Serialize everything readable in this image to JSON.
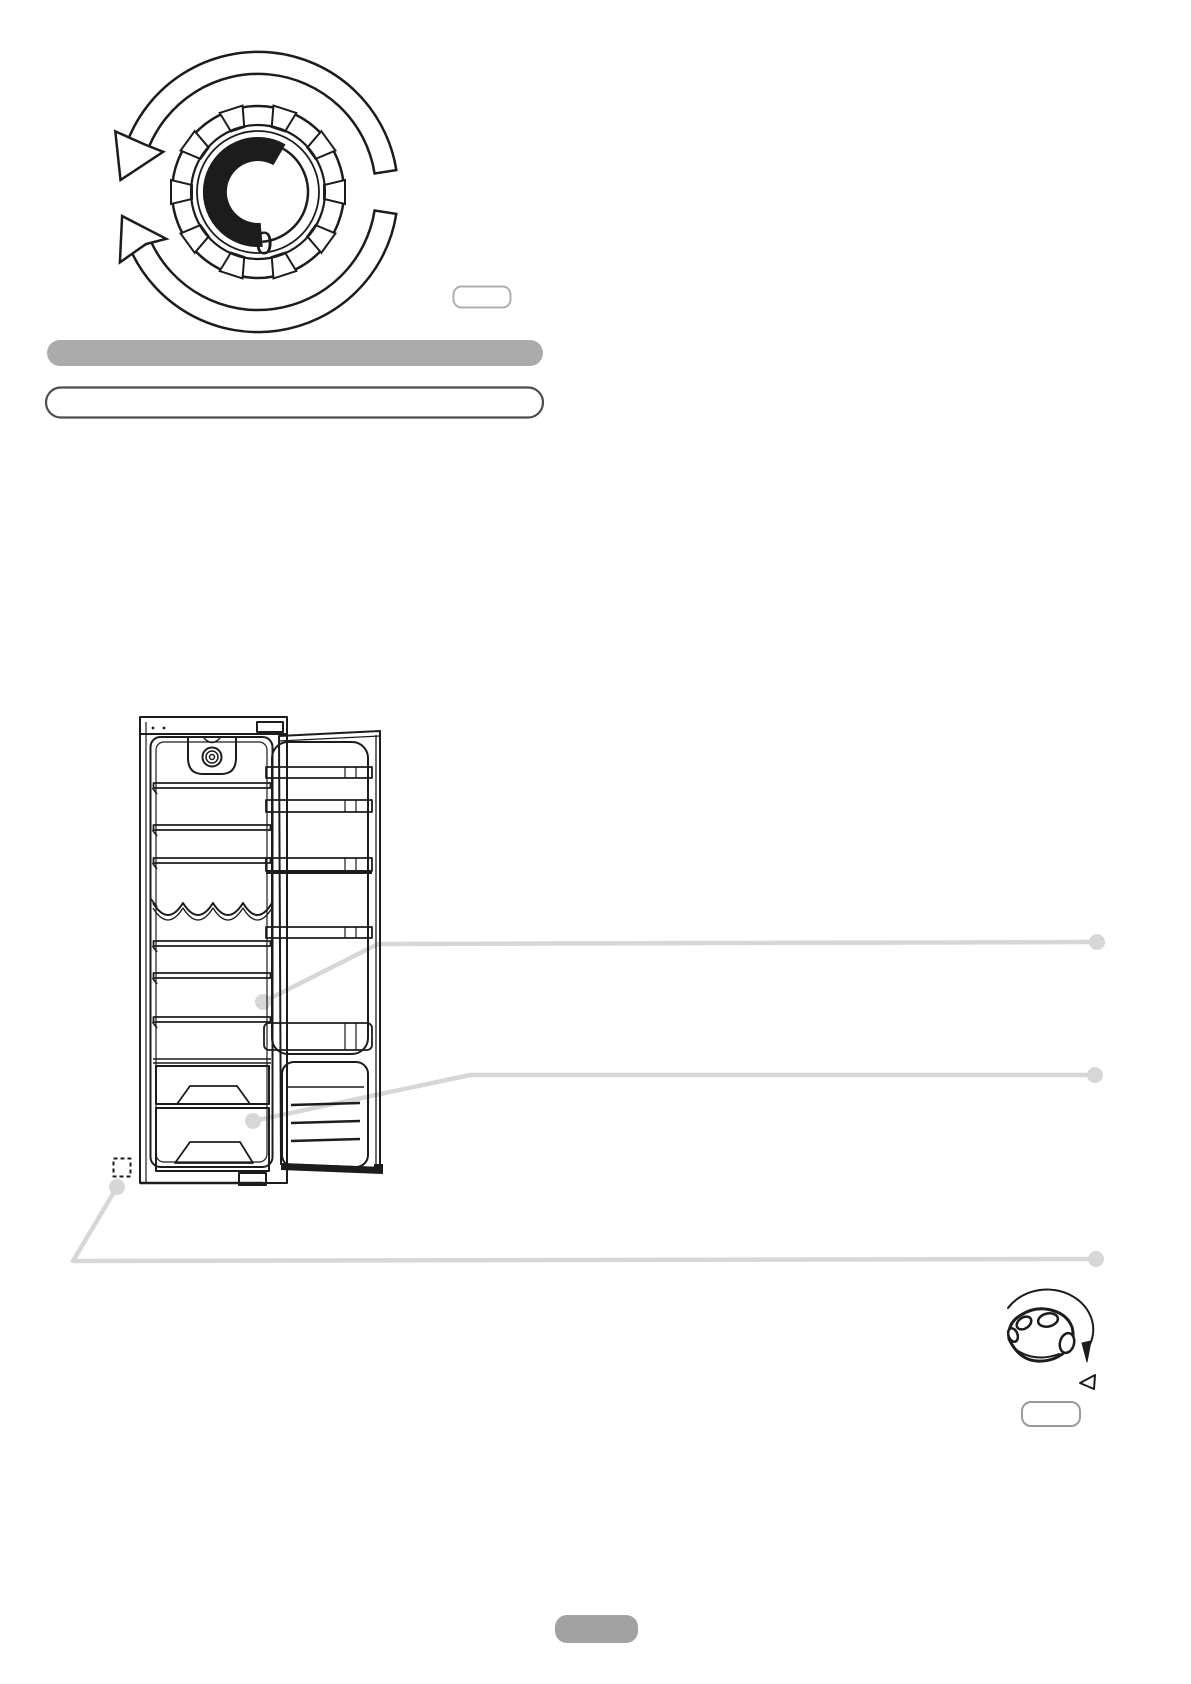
{
  "document": {
    "kind": "refrigerator-manual-page",
    "dial": {
      "zero_label": "0"
    },
    "buttons": {
      "top_pill_label": "",
      "knob_pill_label": "",
      "footer_badge_label": ""
    },
    "redacted": {
      "heading": "",
      "subheading": ""
    }
  },
  "colors": {
    "ink": "#1c1c1c",
    "callout": "#d7d7d7",
    "bar_fill": "#ababab",
    "badge_fill": "#a2a2a2",
    "outline_pill_border": "#4d4d4d",
    "small_pill_border": "#b0b0b0",
    "knob_pill_border": "#9b9b9b"
  }
}
